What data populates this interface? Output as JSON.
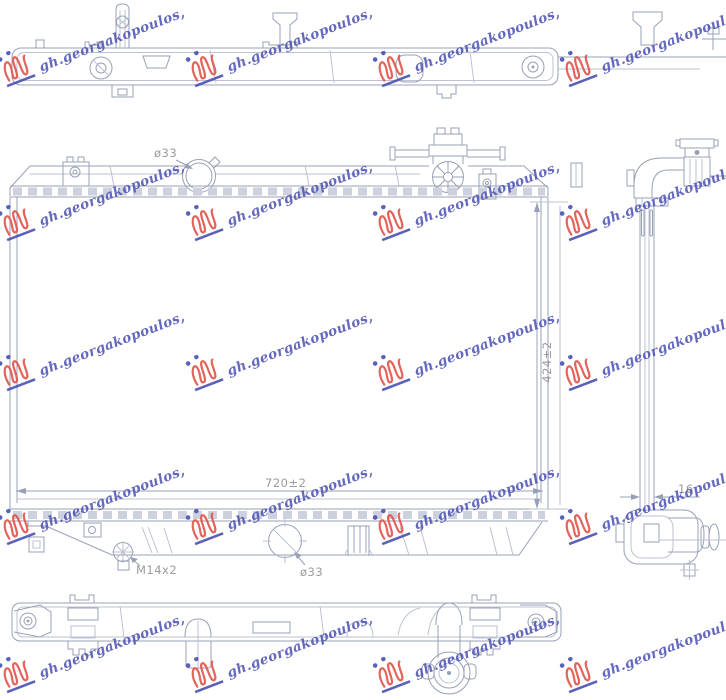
{
  "watermark": {
    "text": "gh.georgakopoulos,",
    "text_color": "#4a50b2",
    "logo_color": "#e2544b"
  },
  "drawing": {
    "line_color": "#98a0b6",
    "line_light": "#bcc2d2",
    "teeth_color": "#ccd1dd",
    "label_color": "#9b9b9b",
    "labels": {
      "top_port_diameter": "ø33",
      "core_height": "424±2",
      "core_width": "720±2",
      "drain_plug_thread": "M14x2",
      "bottom_port_diameter": "ø33",
      "core_thickness": "16"
    }
  }
}
